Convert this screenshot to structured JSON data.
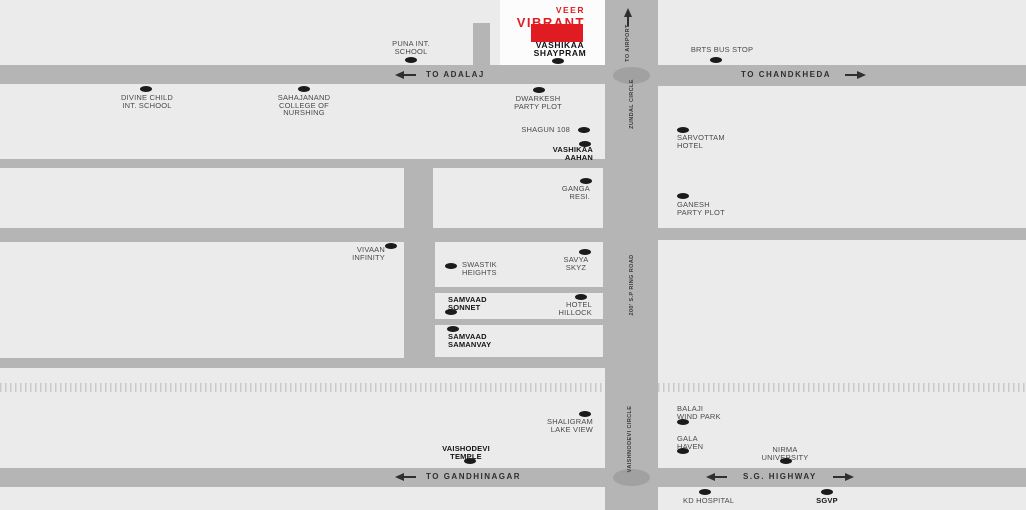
{
  "logo": {
    "veer": "VEER",
    "vibrant": "VIBRANT"
  },
  "project": {
    "name": "VASHIKAA\nSHAYPRAM"
  },
  "roads": {
    "to_adalaj": "TO ADALAJ",
    "to_chandkheda": "TO CHANDKHEDA",
    "to_airport": "TO AIRPORT",
    "zundal_circle": "ZUNDAL CIRCLE",
    "sp_ring_road": "200' S.P RING ROAD",
    "vaishnodevi_circle": "VAISHNODEVI CIRCLE",
    "to_gandhinagar": "TO GANDHINAGAR",
    "sg_highway": "S.G. HIGHWAY"
  },
  "landmarks": {
    "puna": "PUNA INT.\nSCHOOL",
    "divine": "DIVINE CHILD\nINT. SCHOOL",
    "sahajanand": "SAHAJANAND\nCOLLEGE OF\nNURSHING",
    "dwarkesh": "DWARKESH\nPARTY PLOT",
    "shagun": "SHAGUN 108",
    "vashikaa_aahan": "VASHIKAA\nAAHAN",
    "ganga": "GANGA\nRESI.",
    "sarvottam": "SARVOTTAM\nHOTEL",
    "ganesh": "GANESH\nPARTY PLOT",
    "brts": "BRTS BUS STOP",
    "vivaan": "VIVAAN\nINFINITY",
    "swastik": "SWASTIK\nHEIGHTS",
    "savya": "SAVYA\nSKYZ",
    "samvaad_sonnet": "SAMVAAD\nSONNET",
    "hotel_hillock": "HOTEL\nHILLOCK",
    "samvaad_samanvay": "SAMVAAD\nSAMANVAY",
    "shaligram": "SHALIGRAM\nLAKE VIEW",
    "vaishodevi": "VAISHODEVI\nTEMPLE",
    "balaji": "BALAJI\nWIND PARK",
    "gala": "GALA\nHAVEN",
    "nirma": "NIRMA\nUNIVERSITY",
    "kd": "KD HOSPITAL",
    "sgvp": "SGVP"
  },
  "colors": {
    "road_gray": "#b5b5b5",
    "block_gray": "#ebebeb",
    "project_block_white": "#fcfcfc",
    "accent_red": "#e01b22",
    "marker_black": "#1b1b1b",
    "label_gray": "#4a4a4a",
    "label_dark": "#141414",
    "road_label": "#2f2f2f",
    "roundabout_gray": "#a1a1a1",
    "railway_gray": "#c9c9c9"
  }
}
